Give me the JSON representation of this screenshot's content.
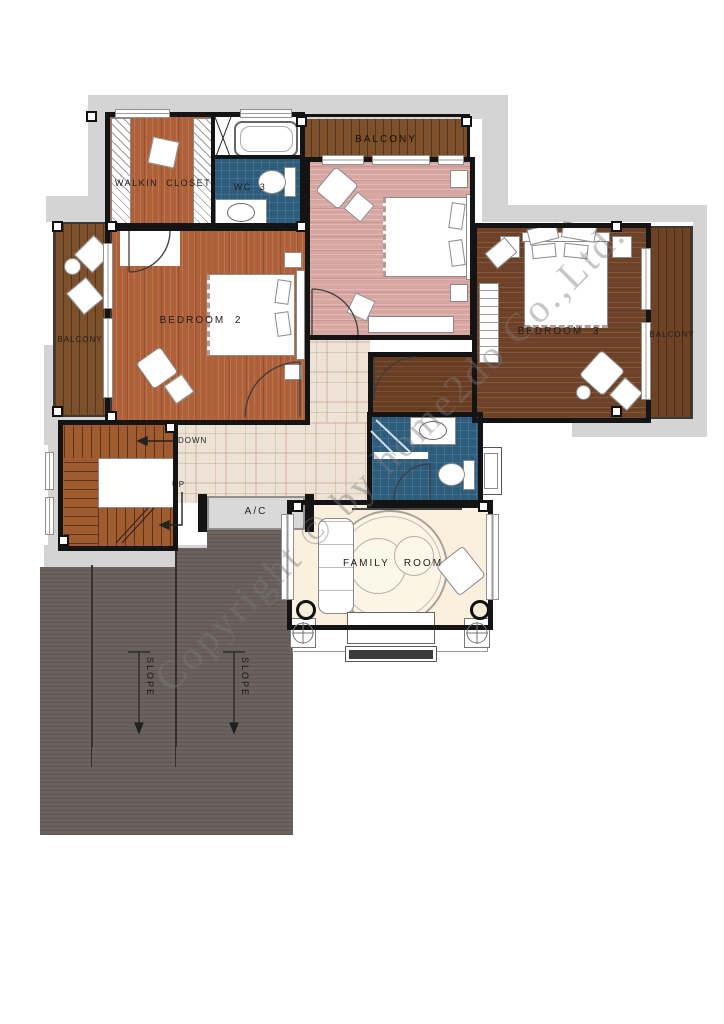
{
  "watermark": {
    "text": "Copyright © by home2do Co.,Ltd."
  },
  "labels": {
    "walkin_closet": "WALKIN  CLOSET",
    "wc3": "WC  3",
    "balcony_top": "BALCONY",
    "balcony_left": "BALCONY",
    "balcony_right": "BALCONY",
    "bedroom2": "BEDROOM  2",
    "bedroom3": "BEDROOM  3",
    "family_room": "FAMILY   ROOM",
    "ac": "A/C",
    "down": "DOWN",
    "up": "UP",
    "slope_left": "SLOPE",
    "slope_right": "SLOPE"
  },
  "colors": {
    "wall": "#141414",
    "eave_band_gray": "#d4d4d4",
    "tile_blue": "#2d5c7c",
    "deck_brown": "#7d502c",
    "deck_brown_dark": "#6e4325",
    "bedroom2_wood": "#ae6038",
    "bedroom3_wood": "#6f4227",
    "master_floor_pink": "#d8a6a1",
    "hall_plaid": "#ece3d6",
    "family_cream": "#faf0dd",
    "roof_gray": "#6b625e",
    "stair_wood": "#a05b30"
  }
}
